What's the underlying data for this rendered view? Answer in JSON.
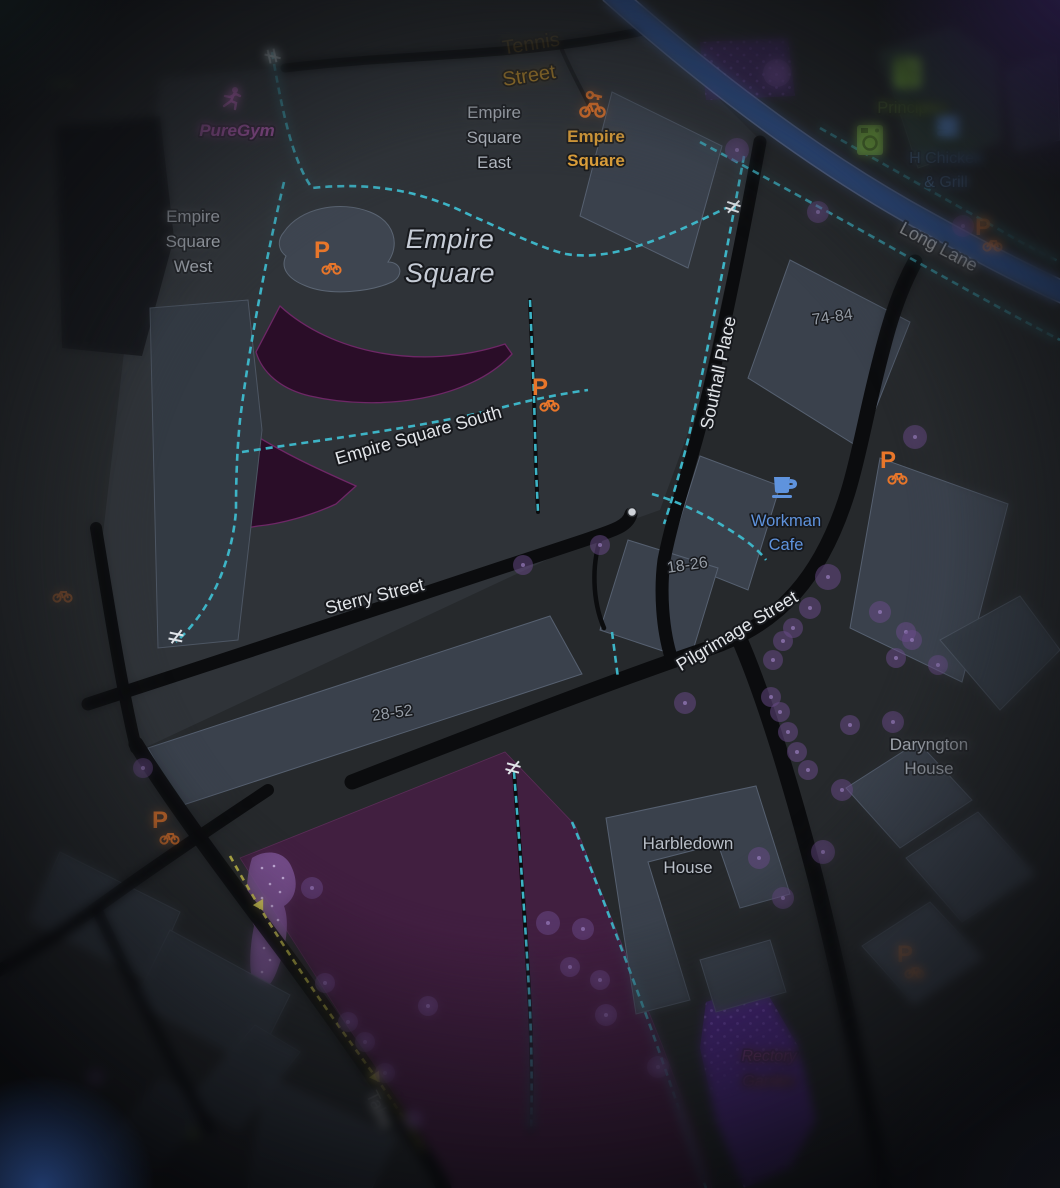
{
  "map_title": "Empire Square area dark map",
  "palette": {
    "base": "#26292c",
    "estate_ground": "#2f3338",
    "building": "#3a414c",
    "building_outline": "#566070",
    "road": "#0b0c0e",
    "long_lane_fill": "#2d4a7d",
    "long_lane_casing": "#91a6df",
    "cycle_path": "#3db4c6",
    "route_yellow": "#ded74f",
    "park_fill": "#54194e",
    "pitch_fill": "#2a0d28",
    "pitch_outline": "#6e2766",
    "garden_fill": "#46257a",
    "garden_dots": "#8f68cc",
    "scrub_fill": "#7b5394",
    "tree": "#6b4b8c",
    "poi_orange": "#e8762a",
    "poi_blue": "#5f93dd",
    "poi_green": "#8fbe52",
    "poi_magenta": "#cb68cb",
    "label_gray": "#b9bfc8",
    "road_label": "#e2e5e9",
    "amber_road_label": "#c9962f",
    "station_label": "#e3a43b",
    "pink_label": "#cf63b2"
  },
  "road_labels": {
    "tennis_street": {
      "line1": "Tennis",
      "line2": "Street"
    },
    "long_lane": "Long Lane",
    "sterry_street": "Sterry Street",
    "pilgrimage_street": "Pilgrimage Street",
    "southall_place": "Southall Place",
    "empire_square_south": "Empire Square South",
    "tabard_street_partial": "Taba"
  },
  "place_labels": {
    "empire_square": {
      "lines": [
        "Empire",
        "Square"
      ]
    },
    "empire_square_west": {
      "lines": [
        "Empire",
        "Square",
        "West"
      ]
    },
    "empire_square_east": {
      "lines": [
        "Empire",
        "Square",
        "East"
      ]
    },
    "daryngton_house": {
      "lines": [
        "Daryngton",
        "House"
      ]
    },
    "harbledown_house": {
      "lines": [
        "Harbledown",
        "House"
      ]
    },
    "rectory_garden": {
      "lines": [
        "Rectory",
        "Garden"
      ]
    },
    "partial_ress": "ress"
  },
  "house_numbers": {
    "a": "74-84",
    "b": "18-26",
    "c": "28-52"
  },
  "pois": {
    "puregym": {
      "label": "PureGym"
    },
    "empire_square_bike_share": {
      "lines": [
        "Empire",
        "Square"
      ]
    },
    "principles": {
      "label": "Principles"
    },
    "h_chicken_grill": {
      "lines": [
        "H Chicken",
        "& Grill"
      ]
    },
    "workman_cafe": {
      "lines": [
        "Workman",
        "Cafe"
      ]
    }
  },
  "symbols": {
    "bike_parking": "P",
    "gate": "≠"
  }
}
